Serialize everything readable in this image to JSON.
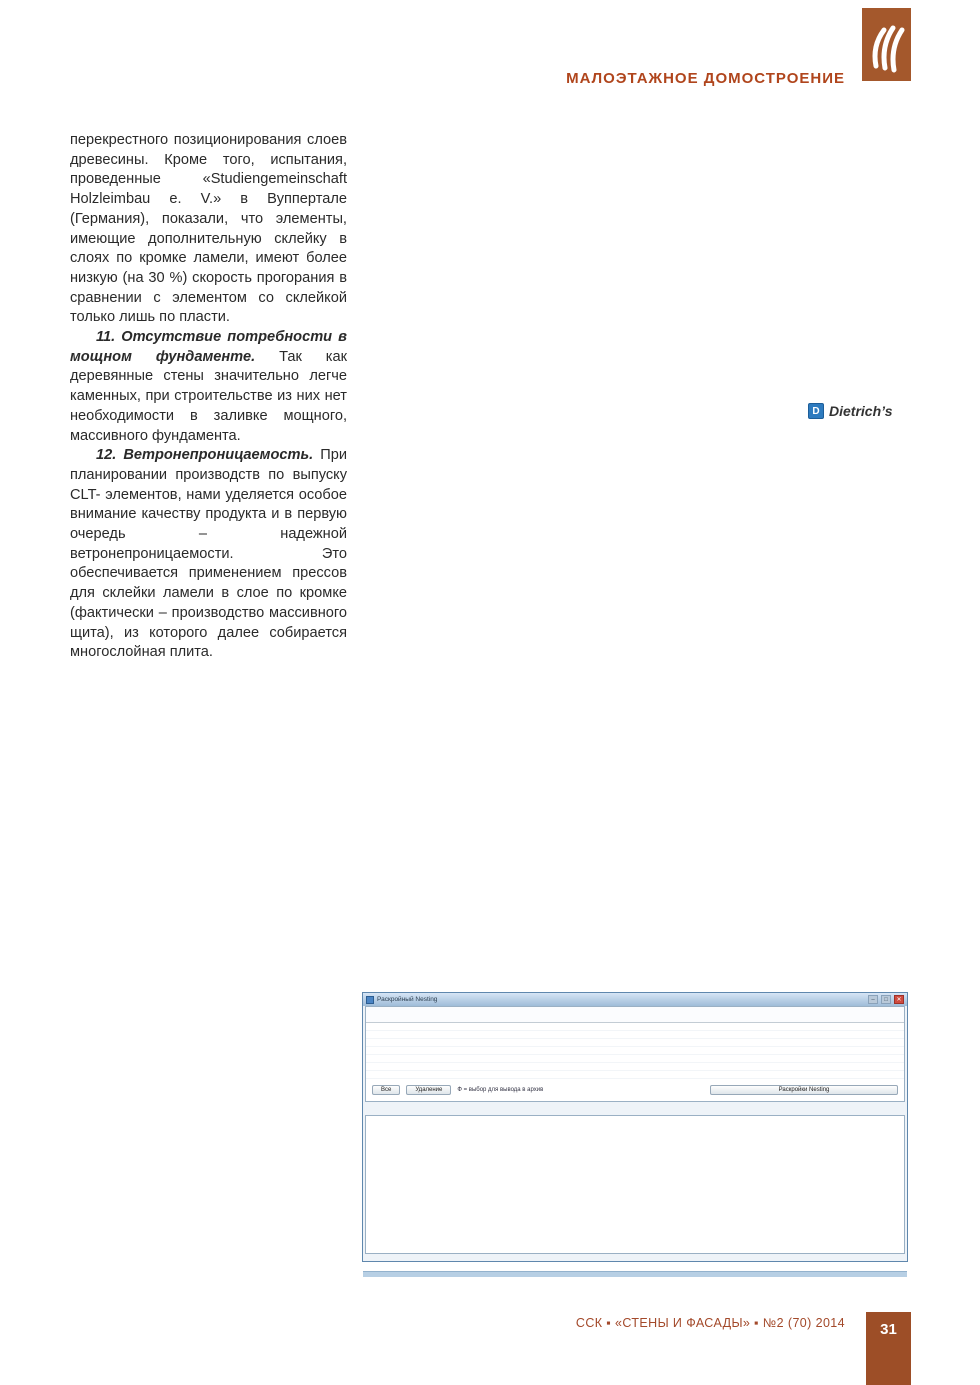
{
  "header": {
    "section_title": "МАЛОЭТАЖНОЕ ДОМОСТРОЕНИЕ"
  },
  "footer": {
    "journal_line": "ССК ▪ «СТЕНЫ И ФАСАДЫ» ▪ №2 (70) 2014",
    "page_number": "31"
  },
  "article": {
    "col_left": [
      {
        "indent": false,
        "text": "перекрестного позиционирования слоев древесины. Кроме того, испытания, проведенные «Studiengemeinschaft Holzleimbau e. V.» в Вуппертале (Германия), показали, что элементы, имеющие дополнительную склейку в слоях по кромке ламели, имеют более низкую (на 30 %) скорость прогорания в сравнении с элементом со склейкой только лишь по пласти."
      },
      {
        "indent": true,
        "lead": "11. Отсутствие потребности в мощном фундаменте.",
        "text": "Так как деревянные стены значительно легче каменных, при строительстве из них нет необходимости в заливке мощного, массивного фундамента."
      },
      {
        "indent": true,
        "lead": "12. Ветронепроницаемость.",
        "text": "При планировании производств по выпуску CLT- элементов, нами уделяется особое внимание качеству продукта и в первую очередь – надежной ветронепроницаемости. Это обеспечивается применением прессов для склейки ламели в слое по кромке (фактически – производство массивного щита), из которого далее собирается многослойная плита."
      },
      {
        "figure": "clt"
      },
      {
        "indent": true,
        "text": "Могут иметь место также и комбинации, когда, скажем, наружные слои состоят из ламели, уложенной без склейки по кромке, а внутренние со склейкой (массивного щита), или наоборот."
      },
      {
        "indent": true,
        "text": "Можно ли всю ламель, во всех слоях укладывать свободно, без склейки по кромке? Безусловно, однако необходимо учитывать, что при одновременном прессовании многих слоев в пакете, для обеспечения плотного прилегания друг к другу, производится поджимание в слое свободно уложенной ламели с боков, но дерево природный материал и всегда имеет какие-либо отклонения от идеального состояния, которые в свою очередь ведут к образованию в слое зазоров между ламелью. Далее, в случае дополнительного высыхания – зазоры увели-"
      }
    ],
    "col_middle": [
      {
        "indent": false,
        "text": "чиваются. И только применение массивного, склеенного по соответствующей технологии щита обеспечивает абсолютное, надежное качество (ветронепроницаемость) готовой платы."
      },
      {
        "indent": true,
        "lead": "13. Короткое время сборки дома",
        "text": "за счет использования крупноформатных деревянных панелей с высоким уровнем предварительной заводской готовности. Так, время сборки одноквартирного дома, как правило, составляет от 12 часов до 3-х дней, в зависимости от объема и сложности конструкции объекта."
      },
      {
        "indent": true,
        "lead": "14. Точность монтажа",
        "text": "за счет изготовления элементов на точном и высокопроизводительном оборудовании."
      },
      {
        "indent": true,
        "text": "Несмотря на то, что мы имеем дело с массивными деревянными конструкциями, длиной до 12 м (а в некоторых случаях и больше), точность изготовления этих элементов лежит и пределах 1 мм, что в свою очередь позволяет говорить о точности изготовления сопрягаемых плоскостей строительных элементов."
      }
    ],
    "col_right": [
      {
        "indent": true,
        "lead": "15. Возможность обеспечения стандартизированного и проверяемого качества.",
        "text": ""
      },
      {
        "indent": true,
        "text": "Применение программного обеспечения, позволяющего перенимать трех дименсиональную задумку архитектора с последующей разбивкой на отдельные стеновые элементы, и просчет, к примеру, несущих возможностей одного или другого элемента, позволяют говорить в надежности строений из CLT-плиты, и соответствии всех несущих характеристик существующим нормам."
      },
      {
        "indent": true,
        "text": "Высокая степень механизации с автоматическим учетом параметров используемых материалов, позволяет, в случае возникновения отклонений качества, проанализировав данные найти и устранить причину (к примеру: доска с повышенной влажностью, клей замороженный или с просроченным сроком, и т. д.)."
      },
      {
        "indent": true,
        "lead": "16. Сравнительно, более низкая себестоимость строительства.",
        "text": ""
      },
      {
        "indent": true,
        "text": "Применение в производстве CLT новых клеевых технологий позволя-"
      }
    ]
  },
  "figures": {
    "house": {
      "logo_text": "Dietrich’s",
      "logo_letter": "D",
      "shapes": [
        {
          "f": "o1",
          "pts": "25,215 25,150 133,33 240,105 240,170"
        },
        {
          "f": "w",
          "pts": "100,141 145,122 145,165 100,184"
        },
        {
          "f": "w",
          "pts": "45,176 75,163 75,193 45,206"
        },
        {
          "f": "o2",
          "pts": "240,105 312,47 370,80 300,140"
        },
        {
          "f": "o3",
          "pts": "240,105 300,140 300,205 240,170"
        },
        {
          "f": "o1",
          "pts": "370,80 410,55 470,85 470,140 410,168 370,135"
        },
        {
          "f": "w",
          "pts": "424,96 454,111 454,139 424,124"
        },
        {
          "f": "o2",
          "pts": "470,85 502,69 532,87 532,128 470,140"
        },
        {
          "f": "g1",
          "pts": "92,178 180,120 265,172 265,298 178,240"
        },
        {
          "f": "g1",
          "pts": "265,130 300,112 300,280 265,298"
        },
        {
          "f": "g4",
          "pts": "180,120 205,105 205,170 180,185"
        },
        {
          "f": "g4",
          "pts": "305,150 430,222 430,300 305,228"
        },
        {
          "f": "w",
          "pts": "345,240 372,256 372,298 345,282"
        },
        {
          "f": "o3",
          "pts": "430,150 470,128 470,176 430,198"
        },
        {
          "f": "g2",
          "pts": "5,152 5,215 245,335 245,272"
        },
        {
          "f": "p",
          "pts": "5,152 5,215 245,335 245,272"
        },
        {
          "f": "w",
          "pts": "58,206 90,222 90,247 58,231"
        },
        {
          "f": "w",
          "pts": "128,236 168,256 168,289 128,269"
        },
        {
          "f": "w",
          "pts": "198,282 226,296 226,323 198,309"
        },
        {
          "f": "g3",
          "pts": "245,272 490,152 490,215 245,335"
        },
        {
          "f": "p",
          "pts": "245,272 490,152 490,215 245,335"
        },
        {
          "f": "w",
          "pts": "298,262 334,244 334,307 298,325"
        },
        {
          "f": "w",
          "pts": "378,224 418,204 418,249 378,269"
        },
        {
          "f": "w",
          "pts": "450,196 478,182 478,223 450,237"
        },
        {
          "f": "g4",
          "pts": "490,152 540,178 540,241 490,215"
        },
        {
          "f": "w",
          "pts": "502,186 526,198 526,229 502,217"
        },
        {
          "f": "g2",
          "pts": "540,178 563,166 563,226 540,241"
        }
      ]
    },
    "clt": {
      "shapes": [
        {
          "f": "t1",
          "pts": "8,52 148,6 262,26 120,74"
        },
        {
          "f": "t2",
          "pts": "52,40 182,13 185,14 55,41"
        },
        {
          "f": "t2",
          "pts": "86,47 218,19 221,20 89,48"
        },
        {
          "f": "t2",
          "pts": "112,58 242,24 245,25 115,59"
        },
        {
          "f": "c1",
          "pts": "8,52 120,74 120,84 8,62"
        },
        {
          "f": "c2",
          "pts": "8,62 120,84 120,90 8,68"
        },
        {
          "f": "c3",
          "pts": "8,68 120,90 120,100 8,78"
        },
        {
          "f": "c2",
          "pts": "8,78 120,100 120,106 8,84"
        },
        {
          "f": "c4",
          "pts": "8,84 120,106 120,116 8,94"
        },
        {
          "f": "c5",
          "pts": "120,74 262,26 262,36 120,84"
        },
        {
          "f": "c6",
          "pts": "120,84 262,36 262,42 120,90"
        },
        {
          "f": "c7",
          "pts": "120,90 262,42 262,52 120,100"
        },
        {
          "f": "c6",
          "pts": "120,100 262,52 262,58 120,106"
        },
        {
          "f": "c8",
          "pts": "120,106 262,58 262,68 120,116"
        }
      ]
    }
  },
  "software": {
    "title": "Раскройный Nesting",
    "window_buttons": [
      "–",
      "□",
      "✕"
    ],
    "table": {
      "headers": [
        "В",
        "№",
        "Индекс (№)",
        "Толщина (Т)",
        "Направление волокон",
        "Сторона на накл. пакет",
        "Ширина (В)",
        "Длина (L)",
        "Используемая длина",
        "%",
        "Содержащиеся детали"
      ],
      "rows": [
        {
          "sel": true,
          "cells": [
            "1",
            "ПСВ 67 34 52 *3",
            "Вн 3/20/50",
            "3-х деталь",
            "RualDetails",
            "4000 (20000)",
            "12940 (20000)",
            "13866.77123",
            "99.2",
            "3; 9; 14; 16; 17; 19; 22; 27; 34; 36; 51; 54; 57; 27; 63; 61; 65; 67; 68; 47; 49; 53; 51; 91; 92; 90; 88;"
          ]
        },
        {
          "sel": false,
          "cells": [
            "2",
            "ПСВ 8 54 91 462",
            "Вн 3/20/50",
            "3-х деталь",
            "RualDetails",
            "4000 (20000)",
            "12940 (20000)",
            "11746.84043",
            "84.7",
            "3; 4; 6; 7; 8; 10; 11; 12; 13; 14; 51; 23; 26; 30; 31; 35; 38; 39; 59; 41; 44; 46; 48; 52; 74; 87;"
          ]
        }
      ]
    },
    "controls": {
      "btn_all": "Все",
      "btn_delete": "Удаление",
      "hint": "Ф = выбор для вывода в архив",
      "btn_nesting": "Раскройки Nesting"
    },
    "toolbar_icons": [
      {
        "name": "zoom-plus",
        "glyph": "✛",
        "color": "#2e8b3a"
      },
      {
        "name": "rotate",
        "glyph": "↻",
        "color": "#d2822a"
      },
      {
        "name": "print",
        "glyph": "⎙",
        "color": "#55636f"
      },
      {
        "name": "delete",
        "glyph": "✕",
        "color": "#c0392b"
      },
      {
        "name": "undo",
        "glyph": "↶",
        "color": "#2a6cb0"
      },
      {
        "name": "redo",
        "glyph": "↷",
        "color": "#2a6cb0"
      },
      {
        "name": "grid",
        "glyph": "▦",
        "color": "#55636f"
      }
    ],
    "buttons_bottom": [
      "Выход",
      "Вывод для обработки изделий",
      "Вывод для чертежей",
      "Вывод для пильной"
    ],
    "btn_cancel": "Отмена",
    "drawing": {
      "pieces": [
        {
          "l": "",
          "f": "none",
          "s": "board",
          "pts": "18,6 518,6 518,126 18,126"
        },
        {
          "l": "48",
          "pts": "18,6 48,6 48,17 18,17"
        },
        {
          "l": "43",
          "pts": "50,6 86,6 86,17 50,17"
        },
        {
          "l": "27",
          "pts": "18,19 48,19 48,30 18,30"
        },
        {
          "l": "42",
          "pts": "50,19 86,19 86,30 50,30"
        },
        {
          "l": "45",
          "pts": "88,6 104,6 97,30 88,30"
        },
        {
          "l": "61",
          "pts": "18,33 118,33 118,126 18,126"
        },
        {
          "l": "4",
          "pts": "122,6 232,6 232,38 122,38"
        },
        {
          "l": "77",
          "pts": "124,42 152,42 174,126 146,126"
        },
        {
          "l": "39",
          "pts": "178,60 216,60 216,126 186,126"
        },
        {
          "l": "22",
          "pts": "220,42 256,42 248,90 220,90"
        },
        {
          "l": "17",
          "pts": "222,94 252,94 252,126 222,126"
        },
        {
          "l": "29",
          "pts": "236,6 330,6 330,40 236,40"
        },
        {
          "l": "20",
          "pts": "262,46 298,46 298,88 262,88"
        },
        {
          "l": "16",
          "pts": "302,46 338,46 338,88 302,88"
        },
        {
          "l": "40",
          "pts": "258,94 348,94 348,126 258,126"
        },
        {
          "l": "60",
          "pts": "342,6 420,6 420,62 342,62"
        },
        {
          "l": "36",
          "pts": "356,68 392,68 392,126 360,126"
        },
        {
          "l": "31",
          "pts": "396,68 428,68 428,126 396,126"
        },
        {
          "l": "50",
          "pts": "430,68 458,68 458,126 430,126"
        },
        {
          "l": "59",
          "pts": "424,6 502,6 502,54 424,54"
        },
        {
          "l": "28",
          "pts": "506,16 516,16 516,44 506,44"
        },
        {
          "l": "7",
          "pts": "462,58 490,58 478,126 462,126"
        },
        {
          "l": "48",
          "pts": "494,60 516,60 516,126 498,126"
        }
      ]
    }
  },
  "colors": {
    "accent_brown": "#a4582c",
    "header_red": "#b0451c",
    "footer_red": "#a3492a",
    "palette": {
      "o1": "#e7b469",
      "o2": "#dda258",
      "o3": "#e2ac5f",
      "g1": "#adb5bc",
      "g2": "#9aa3ab",
      "g3": "#a6afb7",
      "g4": "#8f99a1",
      "w": "#ffffff",
      "p": "url(#planks)",
      "none": "none",
      "t1": "#f0dcc4",
      "t2": "#dcc0a0",
      "c1": "#dca878",
      "c2": "#f4e3cc",
      "c3": "#cf9663",
      "c4": "#d6a071",
      "c5": "#e8c098",
      "c6": "#f7ead6",
      "c7": "#d9a877",
      "c8": "#e0b286",
      "n": "#d9ebe7"
    },
    "strokes": {
      "house": "#7d7464",
      "clt": "#bb9066",
      "piece": "#cd6a5e",
      "board": "#c0504d"
    }
  }
}
